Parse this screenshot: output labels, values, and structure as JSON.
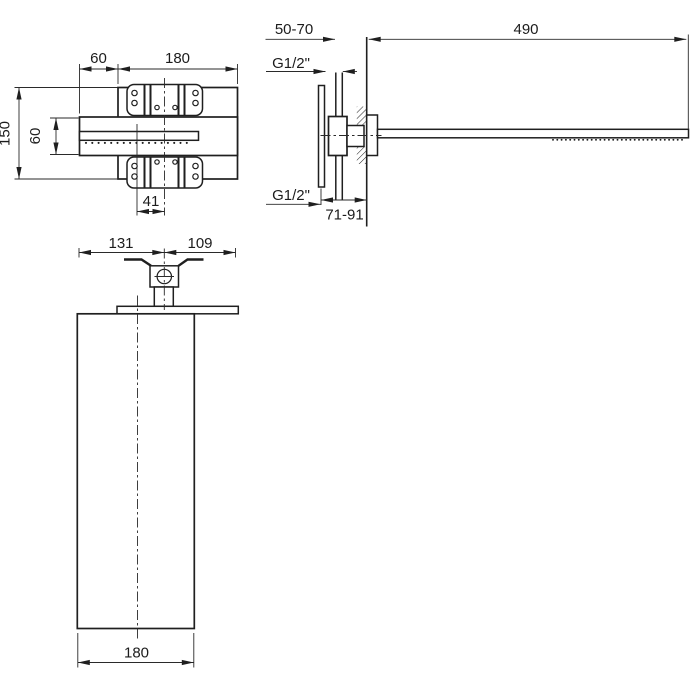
{
  "drawing": {
    "type": "technical-dimension-drawing",
    "subject": "wall-mounted waterfall shower head, three orthographic views",
    "colors": {
      "line": "#1f1f1f",
      "background": "#ffffff"
    },
    "plan": {
      "overhang": "60",
      "plate_width": "180",
      "depth": "150",
      "band_depth": "60",
      "offset": "41"
    },
    "side": {
      "wall_clearance": "50-70",
      "arm_length": "490",
      "thread_top": "G1/2\"",
      "thread_bottom": "G1/2\"",
      "install_depth": "71-91"
    },
    "front": {
      "left_of_axis": "131",
      "right_of_axis": "109",
      "panel_width": "180"
    }
  }
}
